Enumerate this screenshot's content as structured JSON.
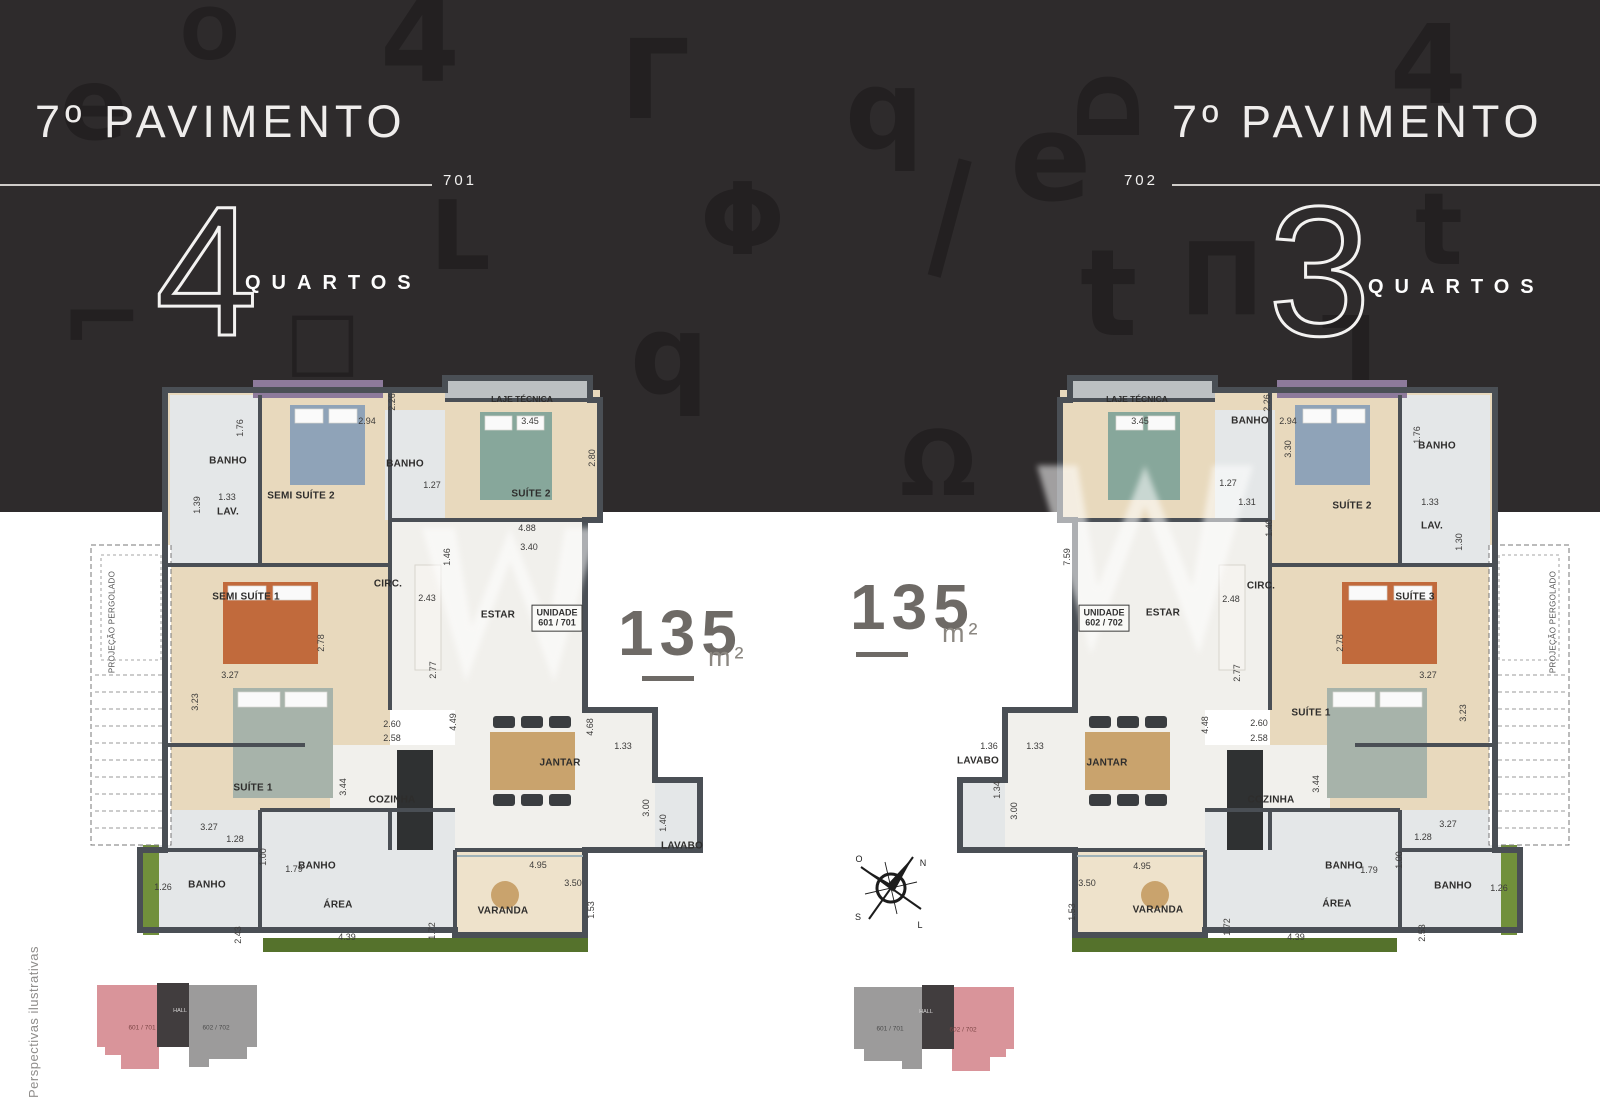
{
  "palette": {
    "band": "#2e2b2c",
    "glyph": "#232021",
    "header-text": "#efedec",
    "rule": "#cfccc9",
    "wall": "#4a4f55",
    "wood": "#e8d9bd",
    "wood2": "#eee2cb",
    "tile": "#e4e7e8",
    "tile2": "#f1f0ec",
    "laje": "#bcc0c2",
    "hedge": "#71903b",
    "hedge2": "#55722c",
    "lavender": "#8d7a9b",
    "counter": "#2f3132",
    "area-num": "#6e6a66",
    "dim": "#3c3b3a",
    "room": "#2e2d2c",
    "kp-pink": "#d9949a",
    "kp-gray": "#9c9b9b",
    "kp-hall": "#413d3e",
    "caption": "#8f8d8b",
    "bed-orange": "#c16a3c",
    "bed-teal": "#87a79b",
    "bed-blue": "#8fa3b8",
    "bed-gray": "#a7b3aa",
    "table": "#c9a36d"
  },
  "panels": [
    {
      "title": "7º PAVIMENTO",
      "unit": "701",
      "bedrooms_number": "4",
      "bedrooms_label": "QUARTOS",
      "area_value": "135",
      "area_unit": "m²"
    },
    {
      "title": "7º PAVIMENTO",
      "unit": "702",
      "bedrooms_number": "3",
      "bedrooms_label": "QUARTOS",
      "area_value": "135",
      "area_unit": "m²"
    }
  ],
  "caption": "Perspectivas ilustrativas",
  "compass": {
    "n": "N",
    "s": "S",
    "l": "L",
    "o": "O"
  },
  "keyplans": [
    {
      "left_label": "601 / 701",
      "hall_label": "HALL",
      "right_label": "602 / 702"
    },
    {
      "left_label": "601 / 701",
      "hall_label": "HALL",
      "right_label": "602 / 702"
    }
  ],
  "decor_glyphs": [
    {
      "ch": "4",
      "x": 380,
      "y": -15,
      "s": 115,
      "r": 0
    },
    {
      "ch": "O",
      "x": 180,
      "y": 0,
      "s": 70,
      "r": 0
    },
    {
      "ch": "e",
      "x": 60,
      "y": 55,
      "s": 100,
      "r": 0
    },
    {
      "ch": "Γ",
      "x": 620,
      "y": 25,
      "s": 110,
      "r": 0
    },
    {
      "ch": "q",
      "x": 845,
      "y": 55,
      "s": 110,
      "r": 0
    },
    {
      "ch": "e",
      "x": 1010,
      "y": 100,
      "s": 120,
      "r": 0
    },
    {
      "ch": "Φ",
      "x": 700,
      "y": 170,
      "s": 100,
      "r": 0
    },
    {
      "ch": "L",
      "x": 430,
      "y": 190,
      "s": 95,
      "r": 0
    },
    {
      "ch": "t",
      "x": 1080,
      "y": 235,
      "s": 120,
      "r": 0
    },
    {
      "ch": "⌐",
      "x": 60,
      "y": 270,
      "s": 100,
      "r": 0
    },
    {
      "ch": "q",
      "x": 630,
      "y": 300,
      "s": 110,
      "r": 0
    },
    {
      "ch": "Ω",
      "x": 900,
      "y": 420,
      "s": 90,
      "r": 0
    },
    {
      "ch": "4",
      "x": 1390,
      "y": 10,
      "s": 110,
      "r": 0
    },
    {
      "ch": "t",
      "x": 1415,
      "y": 180,
      "s": 100,
      "r": 0
    },
    {
      "ch": "Π",
      "x": 1180,
      "y": 230,
      "s": 100,
      "r": 0
    },
    {
      "ch": "D",
      "x": 1075,
      "y": 65,
      "s": 85,
      "r": -90
    },
    {
      "ch": "|",
      "x": 930,
      "y": 150,
      "s": 120,
      "r": 15
    },
    {
      "ch": "□",
      "x": 285,
      "y": 300,
      "s": 80,
      "r": 0
    },
    {
      "ch": "L",
      "x": 1320,
      "y": 300,
      "s": 90,
      "r": 180
    }
  ],
  "plans": [
    {
      "unit": "701",
      "labels": [
        {
          "t": "BANHO",
          "x": 228,
          "y": 461,
          "c": "room"
        },
        {
          "t": "LAV.",
          "x": 228,
          "y": 512,
          "c": "room"
        },
        {
          "t": "SEMI SUÍTE 2",
          "x": 301,
          "y": 496,
          "c": "room"
        },
        {
          "t": "BANHO",
          "x": 405,
          "y": 464,
          "c": "room"
        },
        {
          "t": "SUÍTE 2",
          "x": 531,
          "y": 494,
          "c": "room"
        },
        {
          "t": "LAJE TÉCNICA",
          "x": 522,
          "y": 399,
          "c": "roomsm"
        },
        {
          "t": "CIRC.",
          "x": 388,
          "y": 584,
          "c": "room"
        },
        {
          "t": "ESTAR",
          "x": 498,
          "y": 615,
          "c": "room"
        },
        {
          "t": "SEMI SUÍTE 1",
          "x": 246,
          "y": 597,
          "c": "room"
        },
        {
          "t": "SUÍTE 1",
          "x": 253,
          "y": 788,
          "c": "room"
        },
        {
          "t": "COZINHA",
          "x": 392,
          "y": 800,
          "c": "room"
        },
        {
          "t": "JANTAR",
          "x": 560,
          "y": 763,
          "c": "room"
        },
        {
          "t": "LAVABO",
          "x": 682,
          "y": 846,
          "c": "room"
        },
        {
          "t": "BANHO",
          "x": 317,
          "y": 866,
          "c": "room"
        },
        {
          "t": "BANHO",
          "x": 207,
          "y": 885,
          "c": "room"
        },
        {
          "t": "ÁREA",
          "x": 338,
          "y": 905,
          "c": "room"
        },
        {
          "t": "VARANDA",
          "x": 503,
          "y": 911,
          "c": "room"
        },
        {
          "t": "UNIDADE\n601 / 701",
          "x": 557,
          "y": 618,
          "c": "unitbox"
        },
        {
          "t": "PROJEÇÃO PERGOLADO",
          "x": 112,
          "y": 622,
          "c": "pergola",
          "v": true
        },
        {
          "t": "1.76",
          "x": 240,
          "y": 428,
          "c": "dim",
          "v": true
        },
        {
          "t": "2.94",
          "x": 367,
          "y": 421,
          "c": "dim"
        },
        {
          "t": "2.26",
          "x": 392,
          "y": 402,
          "c": "dim",
          "v": true
        },
        {
          "t": "1.33",
          "x": 227,
          "y": 497,
          "c": "dim"
        },
        {
          "t": "1.39",
          "x": 197,
          "y": 505,
          "c": "dim",
          "v": true
        },
        {
          "t": "1.27",
          "x": 432,
          "y": 485,
          "c": "dim"
        },
        {
          "t": "3.45",
          "x": 530,
          "y": 421,
          "c": "dim"
        },
        {
          "t": "2.80",
          "x": 592,
          "y": 458,
          "c": "dim",
          "v": true
        },
        {
          "t": "4.88",
          "x": 527,
          "y": 528,
          "c": "dim"
        },
        {
          "t": "3.40",
          "x": 529,
          "y": 547,
          "c": "dim"
        },
        {
          "t": "1.46",
          "x": 447,
          "y": 557,
          "c": "dim",
          "v": true
        },
        {
          "t": "2.43",
          "x": 427,
          "y": 598,
          "c": "dim"
        },
        {
          "t": "2.78",
          "x": 321,
          "y": 643,
          "c": "dim",
          "v": true
        },
        {
          "t": "2.77",
          "x": 433,
          "y": 670,
          "c": "dim",
          "v": true
        },
        {
          "t": "3.27",
          "x": 230,
          "y": 675,
          "c": "dim"
        },
        {
          "t": "3.23",
          "x": 195,
          "y": 702,
          "c": "dim",
          "v": true
        },
        {
          "t": "2.60",
          "x": 392,
          "y": 724,
          "c": "dim"
        },
        {
          "t": "2.58",
          "x": 392,
          "y": 738,
          "c": "dim"
        },
        {
          "t": "3.44",
          "x": 343,
          "y": 787,
          "c": "dim",
          "v": true
        },
        {
          "t": "4.49",
          "x": 453,
          "y": 722,
          "c": "dim",
          "v": true
        },
        {
          "t": "4.68",
          "x": 590,
          "y": 727,
          "c": "dim",
          "v": true
        },
        {
          "t": "1.33",
          "x": 623,
          "y": 746,
          "c": "dim"
        },
        {
          "t": "3.00",
          "x": 646,
          "y": 808,
          "c": "dim",
          "v": true
        },
        {
          "t": "1.40",
          "x": 663,
          "y": 823,
          "c": "dim",
          "v": true
        },
        {
          "t": "4.95",
          "x": 538,
          "y": 865,
          "c": "dim"
        },
        {
          "t": "3.50",
          "x": 573,
          "y": 883,
          "c": "dim"
        },
        {
          "t": "1.53",
          "x": 591,
          "y": 910,
          "c": "dim",
          "v": true
        },
        {
          "t": "3.27",
          "x": 209,
          "y": 827,
          "c": "dim"
        },
        {
          "t": "1.28",
          "x": 235,
          "y": 839,
          "c": "dim"
        },
        {
          "t": "1.00",
          "x": 263,
          "y": 857,
          "c": "dim",
          "v": true
        },
        {
          "t": "1.79",
          "x": 294,
          "y": 869,
          "c": "dim"
        },
        {
          "t": "1.26",
          "x": 163,
          "y": 887,
          "c": "dim"
        },
        {
          "t": "2.43",
          "x": 238,
          "y": 935,
          "c": "dim",
          "v": true
        },
        {
          "t": "4.39",
          "x": 347,
          "y": 937,
          "c": "dim"
        },
        {
          "t": "1.72",
          "x": 432,
          "y": 931,
          "c": "dim",
          "v": true
        }
      ]
    },
    {
      "unit": "702",
      "labels": [
        {
          "t": "LAJE TÉCNICA",
          "x": 1137,
          "y": 399,
          "c": "roomsm"
        },
        {
          "t": "BANHO",
          "x": 1250,
          "y": 421,
          "c": "room"
        },
        {
          "t": "CIRC.",
          "x": 1261,
          "y": 586,
          "c": "room"
        },
        {
          "t": "ESTAR",
          "x": 1163,
          "y": 613,
          "c": "room"
        },
        {
          "t": "SUÍTE 2",
          "x": 1352,
          "y": 506,
          "c": "room"
        },
        {
          "t": "BANHO",
          "x": 1437,
          "y": 446,
          "c": "room"
        },
        {
          "t": "LAV.",
          "x": 1432,
          "y": 526,
          "c": "room"
        },
        {
          "t": "SUÍTE 3",
          "x": 1415,
          "y": 597,
          "c": "room"
        },
        {
          "t": "SUÍTE 1",
          "x": 1311,
          "y": 713,
          "c": "room"
        },
        {
          "t": "JANTAR",
          "x": 1107,
          "y": 763,
          "c": "room"
        },
        {
          "t": "LAVABO",
          "x": 978,
          "y": 761,
          "c": "room"
        },
        {
          "t": "COZINHA",
          "x": 1271,
          "y": 800,
          "c": "room"
        },
        {
          "t": "BANHO",
          "x": 1344,
          "y": 866,
          "c": "room"
        },
        {
          "t": "BANHO",
          "x": 1453,
          "y": 886,
          "c": "room"
        },
        {
          "t": "ÁREA",
          "x": 1337,
          "y": 904,
          "c": "room"
        },
        {
          "t": "VARANDA",
          "x": 1158,
          "y": 910,
          "c": "room"
        },
        {
          "t": "UNIDADE\n602 / 702",
          "x": 1104,
          "y": 618,
          "c": "unitbox"
        },
        {
          "t": "PROJEÇÃO PERGOLADO",
          "x": 1553,
          "y": 622,
          "c": "pergola",
          "v": true
        },
        {
          "t": "3.45",
          "x": 1140,
          "y": 421,
          "c": "dim"
        },
        {
          "t": "2.26",
          "x": 1267,
          "y": 403,
          "c": "dim",
          "v": true
        },
        {
          "t": "2.94",
          "x": 1288,
          "y": 421,
          "c": "dim"
        },
        {
          "t": "3.30",
          "x": 1288,
          "y": 449,
          "c": "dim",
          "v": true
        },
        {
          "t": "1.27",
          "x": 1228,
          "y": 483,
          "c": "dim"
        },
        {
          "t": "1.31",
          "x": 1247,
          "y": 502,
          "c": "dim"
        },
        {
          "t": "1.40",
          "x": 1269,
          "y": 528,
          "c": "dim",
          "v": true
        },
        {
          "t": "7.59",
          "x": 1067,
          "y": 557,
          "c": "dim",
          "v": true
        },
        {
          "t": "1.76",
          "x": 1417,
          "y": 435,
          "c": "dim",
          "v": true
        },
        {
          "t": "1.33",
          "x": 1430,
          "y": 502,
          "c": "dim"
        },
        {
          "t": "1.30",
          "x": 1459,
          "y": 542,
          "c": "dim",
          "v": true
        },
        {
          "t": "2.48",
          "x": 1231,
          "y": 599,
          "c": "dim"
        },
        {
          "t": "2.77",
          "x": 1237,
          "y": 673,
          "c": "dim",
          "v": true
        },
        {
          "t": "2.78",
          "x": 1340,
          "y": 643,
          "c": "dim",
          "v": true
        },
        {
          "t": "3.27",
          "x": 1428,
          "y": 675,
          "c": "dim"
        },
        {
          "t": "3.23",
          "x": 1463,
          "y": 713,
          "c": "dim",
          "v": true
        },
        {
          "t": "2.60",
          "x": 1259,
          "y": 723,
          "c": "dim"
        },
        {
          "t": "2.58",
          "x": 1259,
          "y": 738,
          "c": "dim"
        },
        {
          "t": "4.48",
          "x": 1205,
          "y": 725,
          "c": "dim",
          "v": true
        },
        {
          "t": "1.33",
          "x": 1035,
          "y": 746,
          "c": "dim"
        },
        {
          "t": "1.36",
          "x": 989,
          "y": 746,
          "c": "dim"
        },
        {
          "t": "1.34",
          "x": 997,
          "y": 790,
          "c": "dim",
          "v": true
        },
        {
          "t": "3.00",
          "x": 1014,
          "y": 811,
          "c": "dim",
          "v": true
        },
        {
          "t": "4.95",
          "x": 1142,
          "y": 866,
          "c": "dim"
        },
        {
          "t": "3.50",
          "x": 1087,
          "y": 883,
          "c": "dim"
        },
        {
          "t": "1.53",
          "x": 1072,
          "y": 912,
          "c": "dim",
          "v": true
        },
        {
          "t": "1.72",
          "x": 1227,
          "y": 927,
          "c": "dim",
          "v": true
        },
        {
          "t": "3.44",
          "x": 1316,
          "y": 784,
          "c": "dim",
          "v": true
        },
        {
          "t": "3.27",
          "x": 1448,
          "y": 824,
          "c": "dim"
        },
        {
          "t": "1.28",
          "x": 1423,
          "y": 837,
          "c": "dim"
        },
        {
          "t": "1.00",
          "x": 1399,
          "y": 860,
          "c": "dim",
          "v": true
        },
        {
          "t": "1.79",
          "x": 1369,
          "y": 870,
          "c": "dim"
        },
        {
          "t": "1.26",
          "x": 1499,
          "y": 888,
          "c": "dim"
        },
        {
          "t": "2.53",
          "x": 1422,
          "y": 933,
          "c": "dim",
          "v": true
        },
        {
          "t": "4.39",
          "x": 1296,
          "y": 937,
          "c": "dim"
        }
      ]
    }
  ]
}
